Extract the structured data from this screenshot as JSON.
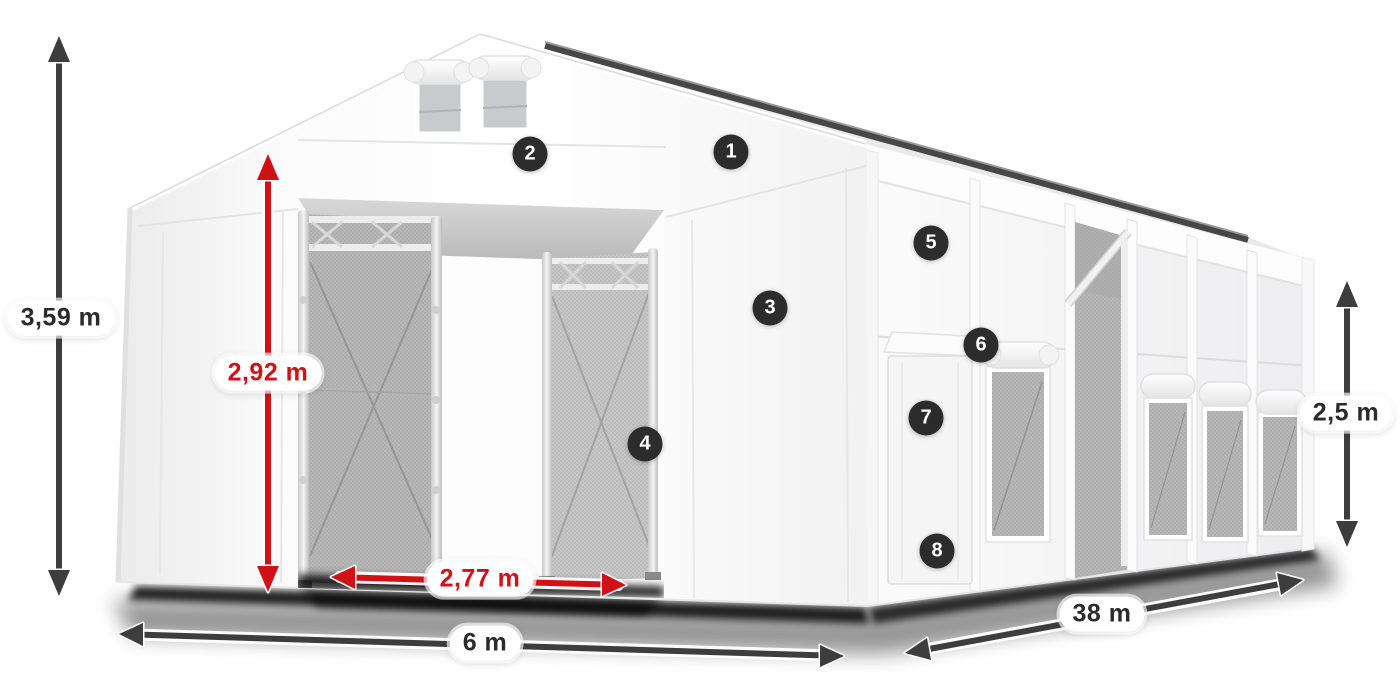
{
  "colors": {
    "accent_red": "#d01218",
    "arrow_dark": "#3d3d3d",
    "badge_bg": "#2c2c2c",
    "pill_text": "#2b2b2b",
    "tent_white": "#fafafa",
    "mesh_gray": "#b7b7b7"
  },
  "dimensions": [
    {
      "id": "total-height",
      "value": "3,59 m",
      "style": "black"
    },
    {
      "id": "entrance-height",
      "value": "2,92 m",
      "style": "red"
    },
    {
      "id": "entrance-width",
      "value": "2,77 m",
      "style": "red"
    },
    {
      "id": "front-width",
      "value": "6 m",
      "style": "black"
    },
    {
      "id": "length",
      "value": "38 m",
      "style": "black"
    },
    {
      "id": "side-height",
      "value": "2,5 m",
      "style": "black"
    }
  ],
  "markers": [
    {
      "label": "1"
    },
    {
      "label": "2"
    },
    {
      "label": "3"
    },
    {
      "label": "4"
    },
    {
      "label": "5"
    },
    {
      "label": "6"
    },
    {
      "label": "7"
    },
    {
      "label": "8"
    }
  ]
}
